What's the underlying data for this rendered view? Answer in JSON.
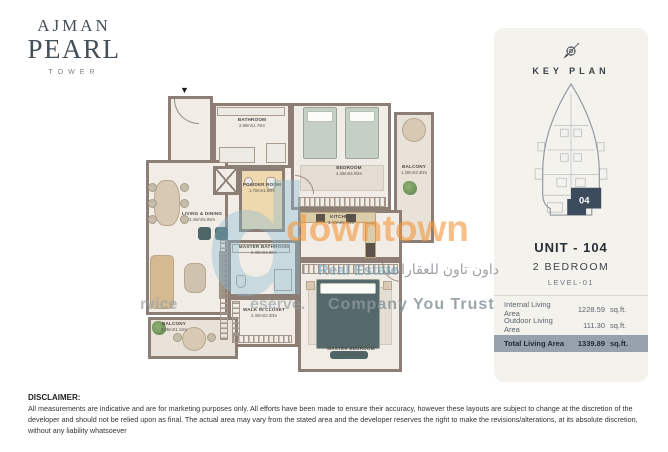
{
  "logo": {
    "line1": "AJMAN",
    "line2": "PEARL",
    "line3": "TOWER"
  },
  "floor_plan": {
    "north_arrow_glyph": "▼",
    "rooms": [
      {
        "name": "BATHROOM",
        "dims": "2.80mX1.75m"
      },
      {
        "name": "BEDROOM",
        "dims": "4.40mX4.05m"
      },
      {
        "name": "BALCONY",
        "dims": "1.30mX3.30m"
      },
      {
        "name": "POWDER ROOM",
        "dims": "1.70mX1.60m"
      },
      {
        "name": "LIVING & DINING",
        "dims": "3.40mX5.85m"
      },
      {
        "name": "KITCHEN",
        "dims": "3.40mX2.40m"
      },
      {
        "name": "MASTER BATHROOM",
        "dims": "2.40mX2.60m"
      },
      {
        "name": "WALK  IN CLOSET",
        "dims": "2.40mX2.30m"
      },
      {
        "name": "MASTER BEDROOM",
        "dims": "4.60mX3.70m"
      },
      {
        "name": "BALCONY",
        "dims": "3.36mX1.10m"
      }
    ]
  },
  "watermark": {
    "logo_letter": "d",
    "brand": "downtown",
    "brand_sub": "Real Estate",
    "brand_arabic": "داون تاون للعقارات",
    "tagline_left": "rvice",
    "tagline_mid": "eserve.",
    "tagline_right": "Company You Trust"
  },
  "key_panel": {
    "title": "KEY PLAN",
    "unit_number": "04",
    "unit_title": "UNIT - 104",
    "unit_type": "2 BEDROOM",
    "level": "LEVEL-01",
    "areas": [
      {
        "label": "Internal Living Area",
        "value": "1228.59",
        "unit": "sq.ft."
      },
      {
        "label": "Outdoor Living Area",
        "value": "111.30",
        "unit": "sq.ft."
      },
      {
        "label": "Total Living Area",
        "value": "1339.89",
        "unit": "sq.ft."
      }
    ],
    "colors": {
      "unit_highlight": "#3d4c5c",
      "total_row_bg": "#97a1ab"
    }
  },
  "disclaimer": {
    "title": "DISCLAIMER:",
    "text": "All measurements are indicative and are for marketing purposes only. All efforts have been made to ensure their accuracy, however these layouts are subject to change at the discretion of the developer and should not be relied upon as final. The actual area may vary from the stated area and the developer reserves the right to make the revisions/alterations, at its absolute discretion, without any liability whatsoever"
  }
}
